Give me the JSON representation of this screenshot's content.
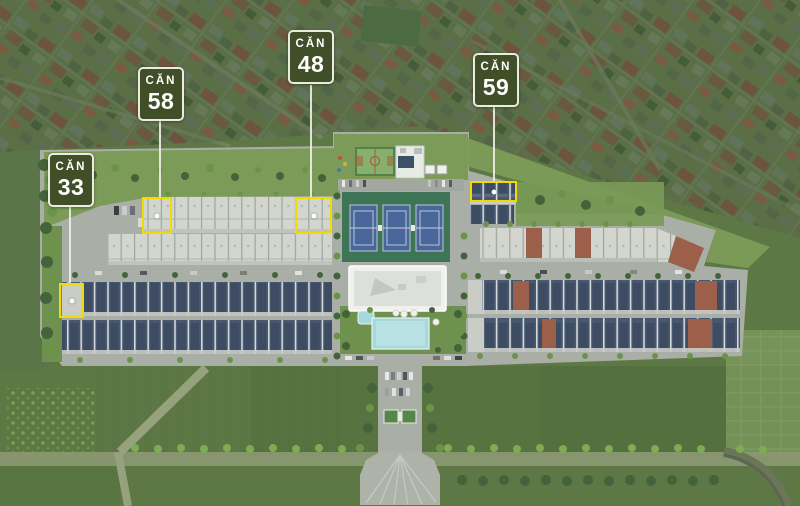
{
  "markers": [
    {
      "id": "unit-33",
      "prefix": "CĂN",
      "number": "33"
    },
    {
      "id": "unit-58",
      "prefix": "CĂN",
      "number": "58"
    },
    {
      "id": "unit-48",
      "prefix": "CĂN",
      "number": "48"
    },
    {
      "id": "unit-59",
      "prefix": "CĂN",
      "number": "59"
    }
  ],
  "colors": {
    "marker-bg": "#414F28",
    "marker-border": "#EAECE0",
    "marker-text": "#FFFFFF",
    "highlight-yellow": "#F2DC00",
    "leader-line": "#EEF0E6",
    "village-base": "#66794F",
    "field-green": "#5E7845",
    "site-ground": "#A9AFA6",
    "site-grass": "#7C9B58",
    "white-roof": "#D2D6CF",
    "dark-roof": "#47576E",
    "terracotta-roof": "#9C5F49",
    "tennis-green": "#3E7557",
    "tennis-blue": "#49679A",
    "pool-cyan": "#A5D8DC",
    "tree-green": "#43633A"
  }
}
